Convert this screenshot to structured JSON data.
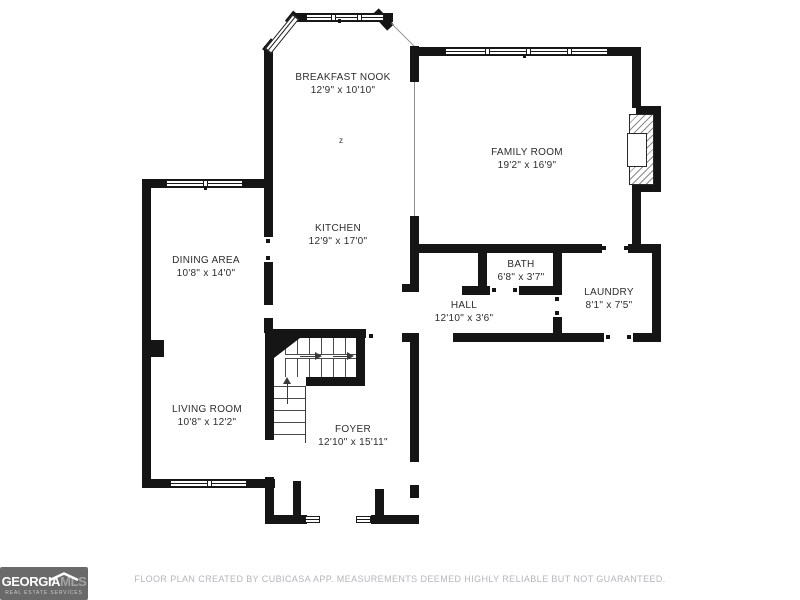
{
  "rooms": [
    {
      "id": "breakfast-nook",
      "name": "BREAKFAST NOOK",
      "dims": "12'9\" x 10'10\""
    },
    {
      "id": "family-room",
      "name": "FAMILY ROOM",
      "dims": "19'2\" x 16'9\""
    },
    {
      "id": "kitchen",
      "name": "KITCHEN",
      "dims": "12'9\" x 17'0\""
    },
    {
      "id": "dining-area",
      "name": "DINING AREA",
      "dims": "10'8\" x 14'0\""
    },
    {
      "id": "bath",
      "name": "BATH",
      "dims": "6'8\" x 3'7\""
    },
    {
      "id": "hall",
      "name": "HALL",
      "dims": "12'10\" x 3'6\""
    },
    {
      "id": "laundry",
      "name": "LAUNDRY",
      "dims": "8'1\" x 7'5\""
    },
    {
      "id": "living-room",
      "name": "LIVING ROOM",
      "dims": "10'8\" x 12'2\""
    },
    {
      "id": "foyer",
      "name": "FOYER",
      "dims": "12'10\" x 15'11\""
    }
  ],
  "annotations": {
    "stair_marker": "z"
  },
  "footer": {
    "disclaimer": "FLOOR PLAN CREATED BY CUBICASA APP. MEASUREMENTS DEEMED HIGHLY RELIABLE BUT NOT GUARANTEED."
  },
  "logo": {
    "brand_primary": "GEORGIA",
    "brand_secondary": "MLS",
    "tagline": "REAL ESTATE SERVICES"
  },
  "colors": {
    "wall": "#151515",
    "label_text": "#2d2d2d",
    "footer_text": "#b6b6ba",
    "logo_background": "#6a6a6a",
    "logo_secondary_text": "#a2a2a2"
  }
}
